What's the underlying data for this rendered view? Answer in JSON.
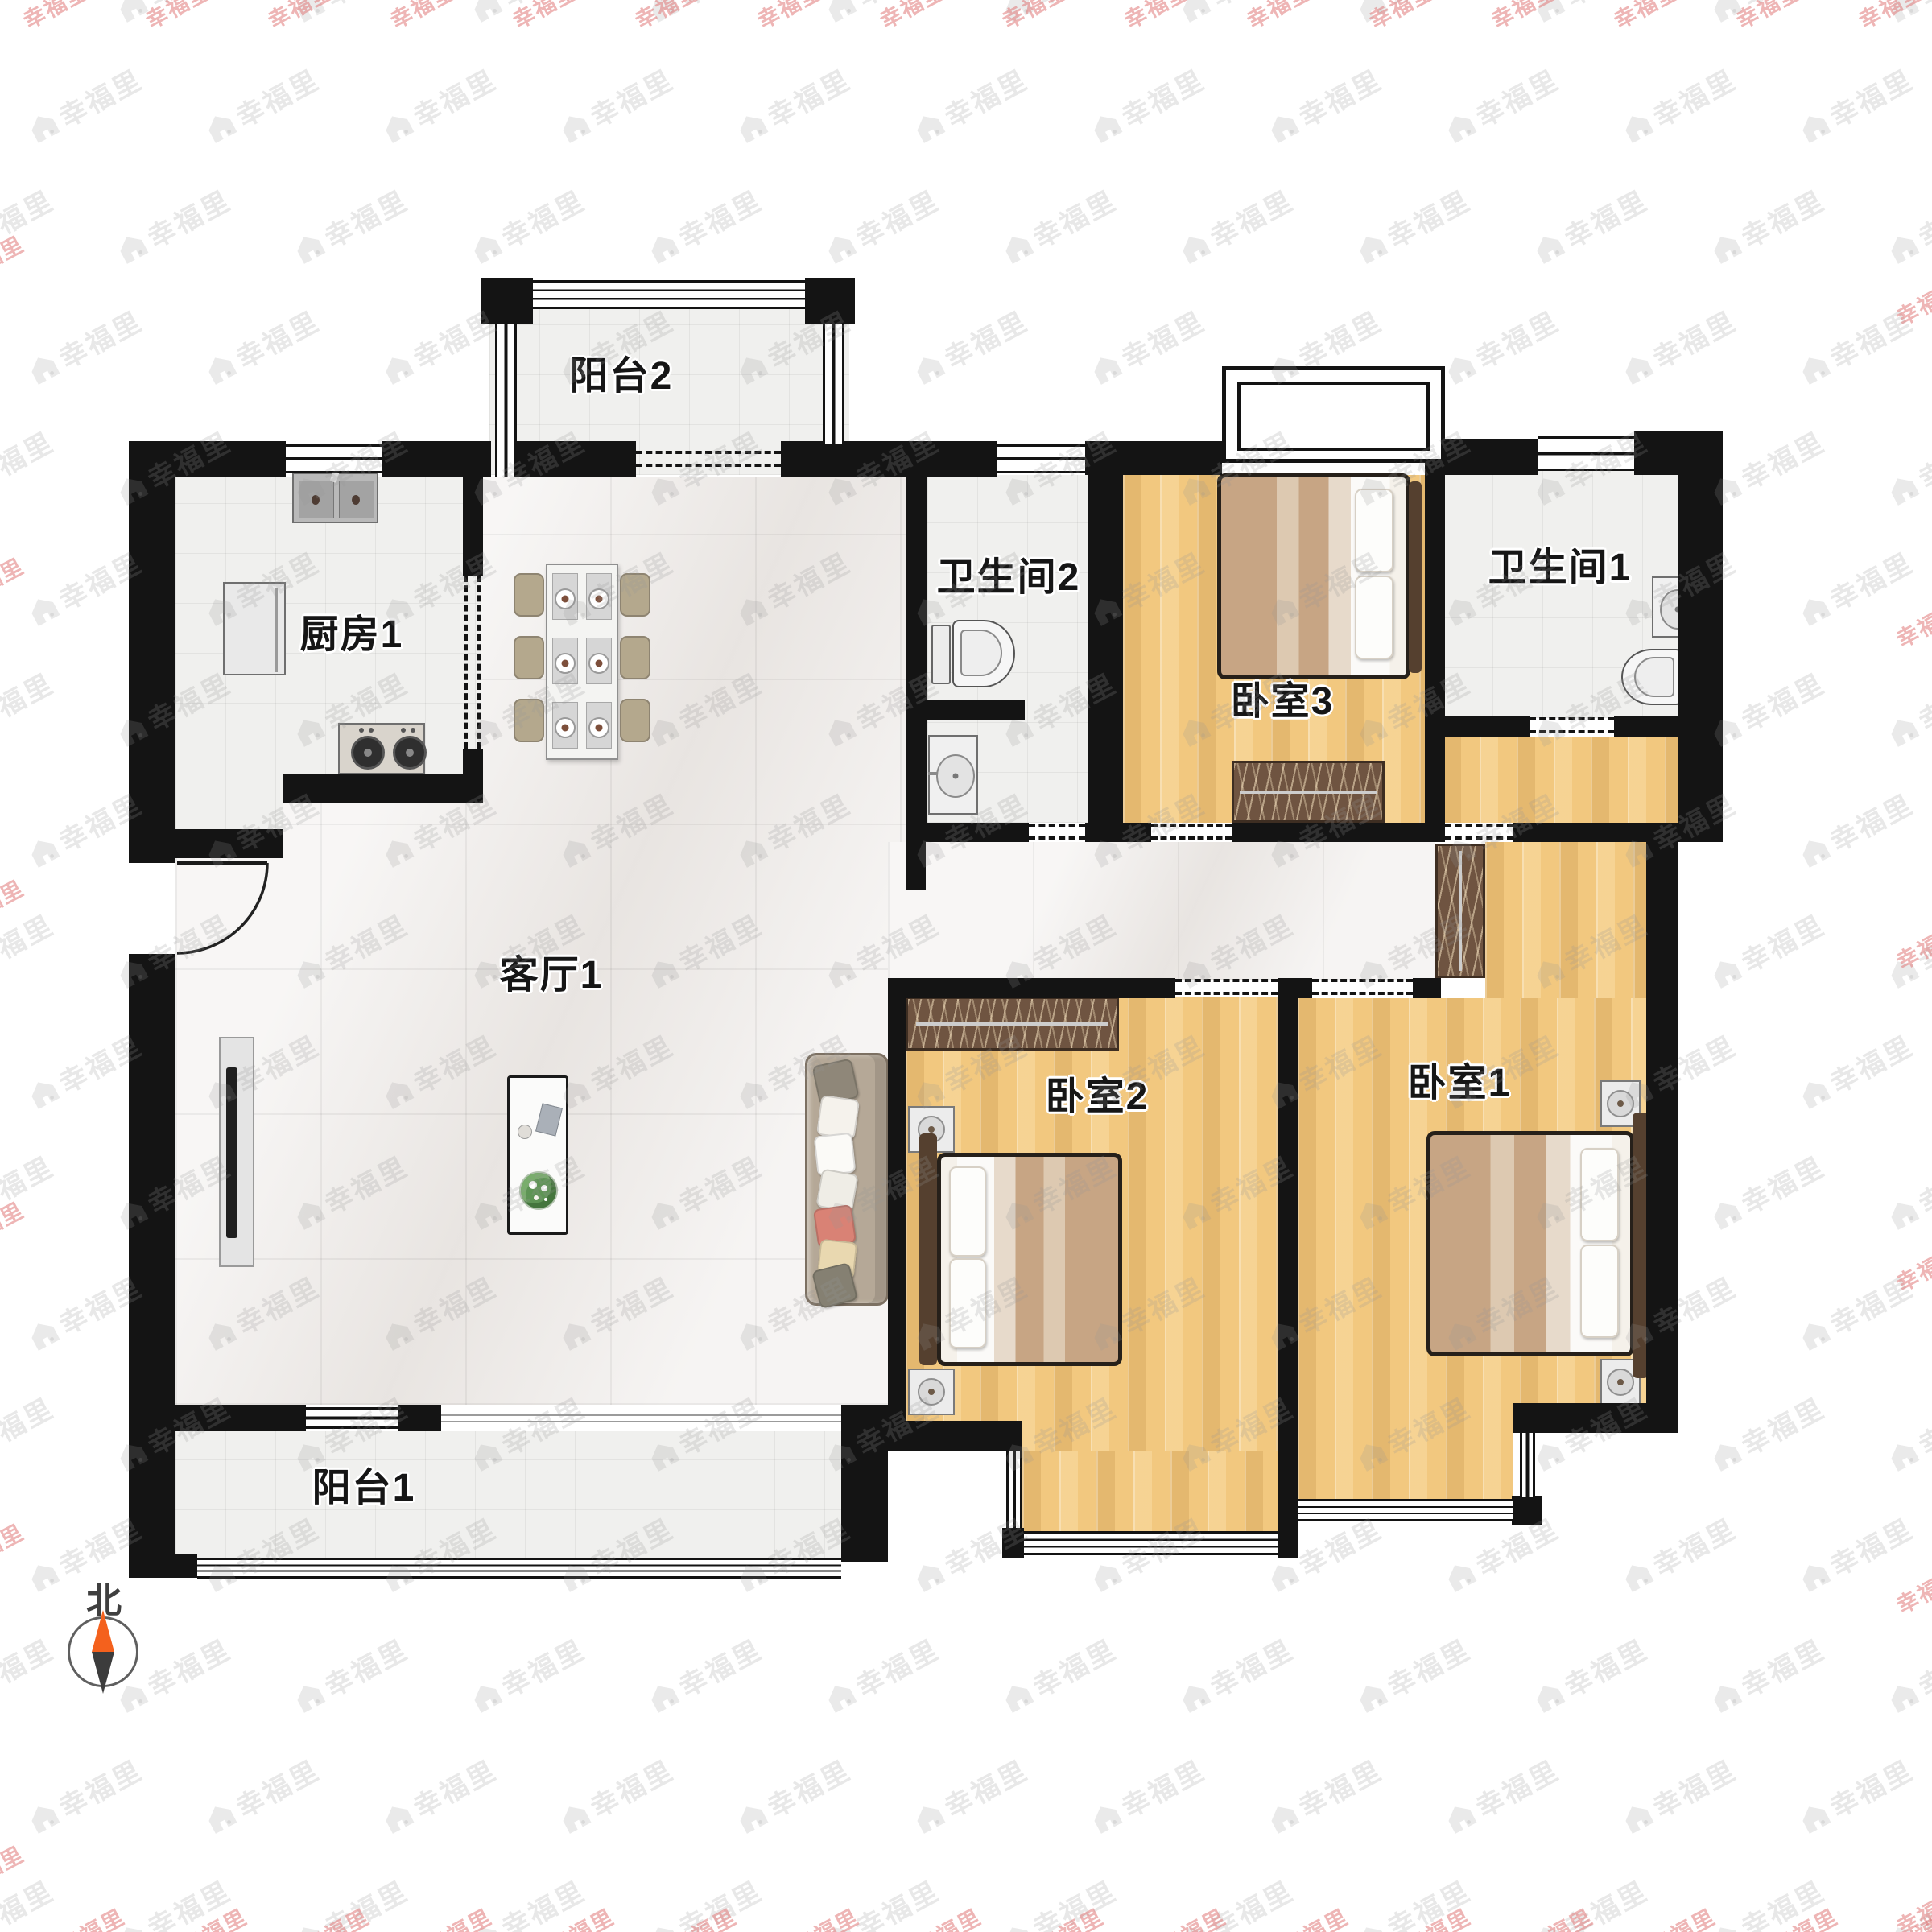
{
  "watermark": {
    "text": "幸福里"
  },
  "compass": {
    "north_label": "北"
  },
  "rooms": {
    "balcony2": {
      "label": "阳台2"
    },
    "kitchen1": {
      "label": "厨房1"
    },
    "bathroom2": {
      "label": "卫生间2"
    },
    "bedroom3": {
      "label": "卧室3"
    },
    "bathroom1": {
      "label": "卫生间1"
    },
    "living1": {
      "label": "客厅1"
    },
    "bedroom2": {
      "label": "卧室2"
    },
    "bedroom1": {
      "label": "卧室1"
    },
    "balcony1": {
      "label": "阳台1"
    }
  },
  "colors": {
    "wall": "#141414",
    "wood_floor": "#f2c87f",
    "marble_floor": "#f0edeb",
    "tile_floor": "#f0f0ee",
    "wardrobe": "#6f5441",
    "compass_north": "#f4611d",
    "compass_south": "#3c3c3c",
    "watermark_gray": "#ededed",
    "watermark_edge_red": "#e08585",
    "plant_green": "#4c8a4a"
  }
}
